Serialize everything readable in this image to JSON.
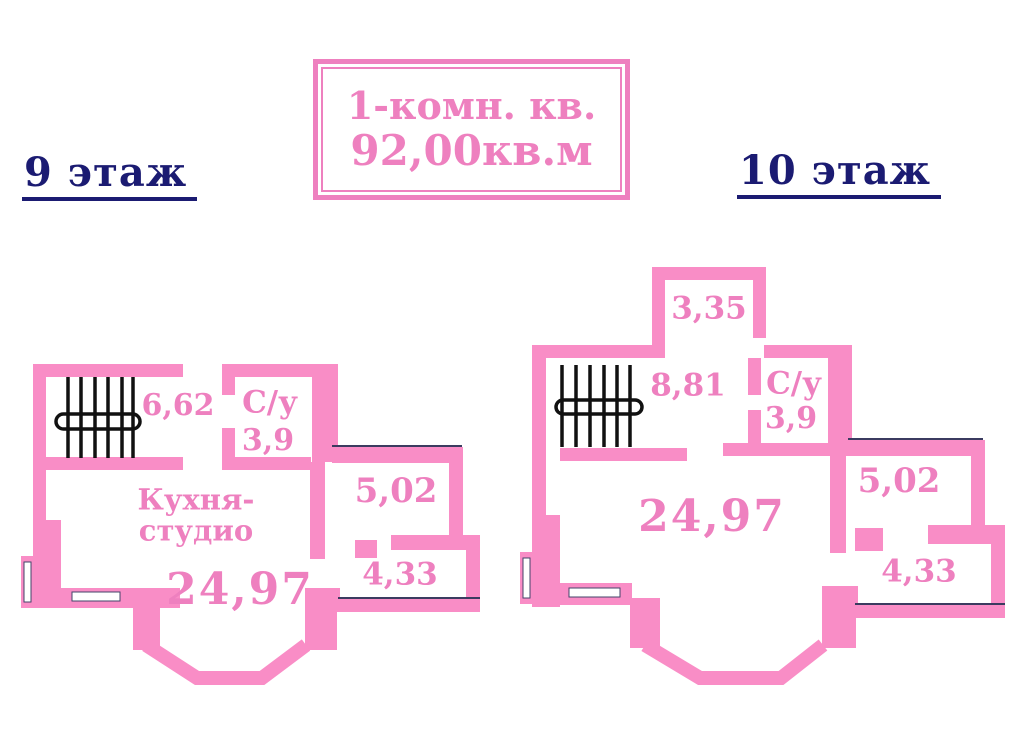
{
  "title_box": {
    "line1": "1-комн. кв.",
    "line2": "92,00кв.м"
  },
  "floors": {
    "floor9": {
      "heading": "9 этаж",
      "rooms": {
        "stairwell_area": "6,62",
        "bathroom_label": "С/у",
        "bathroom_area": "3,9",
        "kitchen_line1": "Кухня-",
        "kitchen_line2": "студио",
        "main_room_area": "24,97",
        "room_right_upper_area": "5,02",
        "room_right_lower_area": "4,33"
      }
    },
    "floor10": {
      "heading": "10 этаж",
      "rooms": {
        "balcony_area": "3,35",
        "stairwell_area": "8,81",
        "bathroom_label": "С/у",
        "bathroom_area": "3,9",
        "main_room_area": "24,97",
        "room_right_upper_area": "5,02",
        "room_right_lower_area": "4,33"
      }
    }
  },
  "colors": {
    "wall_pink": "#f98dc6",
    "text_pink": "#ee80bf",
    "heading_navy": "#1b1b72",
    "stairs_black": "#111111"
  }
}
